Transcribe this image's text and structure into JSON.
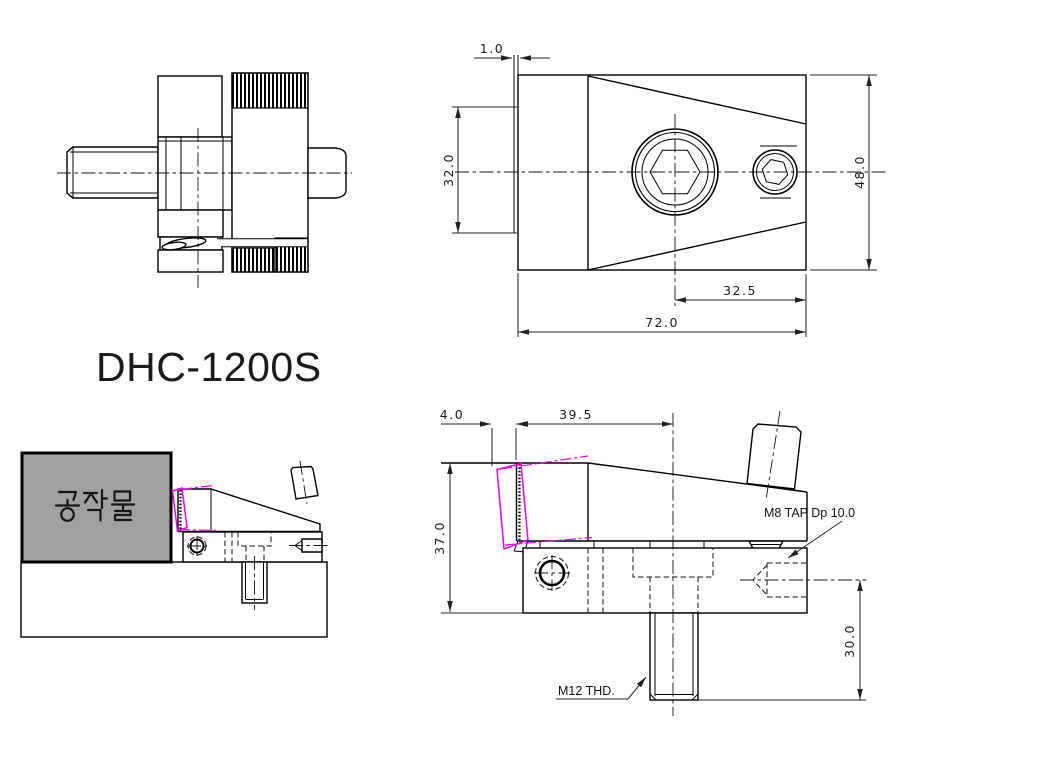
{
  "title": "DHC-1200S",
  "colors": {
    "line": "#000000",
    "dimension": "#222222",
    "phantom_magenta": "#f400f4",
    "workpiece_fill": "#a0a0a0"
  },
  "front_view": {
    "dim_edge": "1.0",
    "dim_inner_height": "32.0",
    "dim_overall_height": "48.0",
    "dim_hole_to_edge": "32.5",
    "dim_overall_width": "72.0"
  },
  "side_view": {
    "dim_stroke": "4.0",
    "dim_top_length": "39.5",
    "dim_overall_height": "37.0",
    "dim_stud_length": "30.0",
    "label_m8_tap": "M8 TAP Dp 10.0",
    "label_m12_thread": "M12 THD."
  },
  "assembly_view": {
    "workpiece_label": "공작물"
  }
}
